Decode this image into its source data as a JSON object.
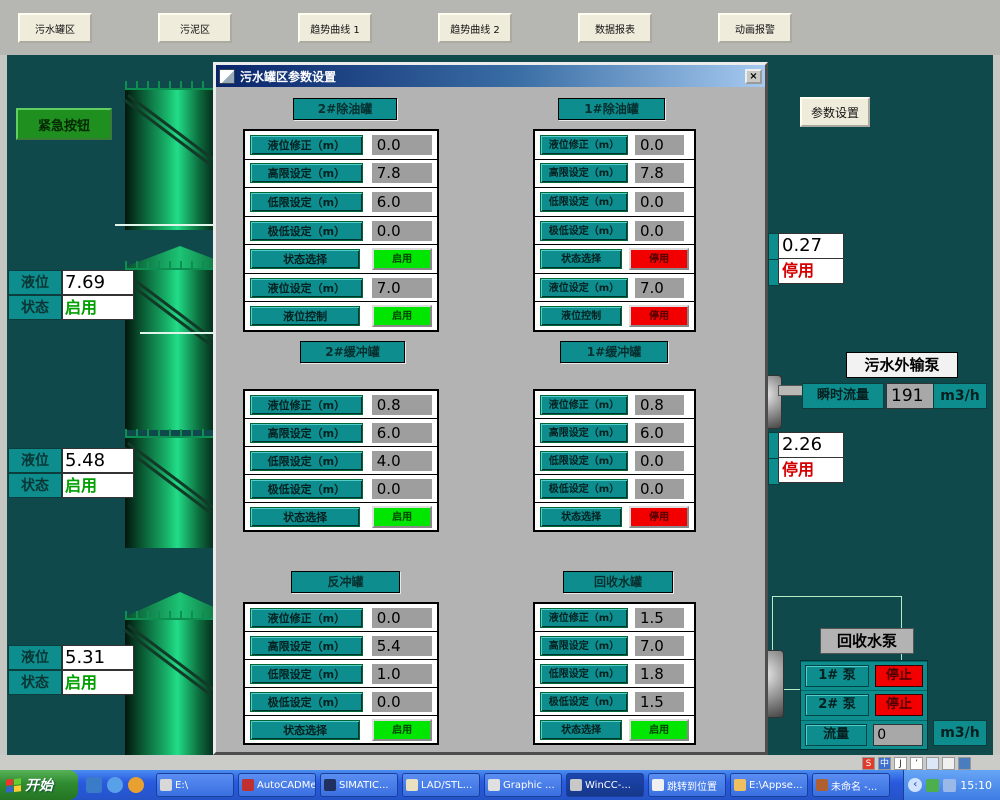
{
  "top_nav": {
    "buttons": [
      {
        "label": "污水罐区"
      },
      {
        "label": "污泥区"
      },
      {
        "label": "趋势曲线 1"
      },
      {
        "label": "趋势曲线 2"
      },
      {
        "label": "数据报表"
      },
      {
        "label": "动画报警"
      }
    ]
  },
  "left_panel": {
    "emergency_button": "紧急按钮",
    "tanks": [
      {
        "level_label": "液位",
        "level_value": "7.69",
        "status_label": "状态",
        "status_value": "启用"
      },
      {
        "level_label": "液位",
        "level_value": "5.48",
        "status_label": "状态",
        "status_value": "启用"
      },
      {
        "level_label": "液位",
        "level_value": "5.31",
        "status_label": "状态",
        "status_value": "启用"
      }
    ]
  },
  "dialog": {
    "title": "污水罐区参数设置",
    "close_label": "×",
    "panels": [
      {
        "header": "2#除油罐",
        "rows": [
          {
            "label": "液位修正（m）",
            "value": "0.0",
            "type": "v"
          },
          {
            "label": "高限设定（m）",
            "value": "7.8",
            "type": "v"
          },
          {
            "label": "低限设定（m）",
            "value": "6.0",
            "type": "v"
          },
          {
            "label": "极低设定（m）",
            "value": "0.0",
            "type": "v"
          },
          {
            "label": "状态选择",
            "value": "启用",
            "type": "g"
          },
          {
            "label": "液位设定（m）",
            "value": "7.0",
            "type": "v"
          },
          {
            "label": "液位控制",
            "value": "启用",
            "type": "g"
          }
        ]
      },
      {
        "header": "1#除油罐",
        "rows": [
          {
            "label": "液位修正（m）",
            "value": "0.0",
            "type": "v"
          },
          {
            "label": "高限设定（m）",
            "value": "7.8",
            "type": "v"
          },
          {
            "label": "低限设定（m）",
            "value": "0.0",
            "type": "v"
          },
          {
            "label": "极低设定（m）",
            "value": "0.0",
            "type": "v"
          },
          {
            "label": "状态选择",
            "value": "停用",
            "type": "r"
          },
          {
            "label": "液位设定（m）",
            "value": "7.0",
            "type": "v"
          },
          {
            "label": "液位控制",
            "value": "停用",
            "type": "r"
          }
        ]
      },
      {
        "header": "2#缓冲罐",
        "rows": [
          {
            "label": "液位修正（m）",
            "value": "0.8",
            "type": "v"
          },
          {
            "label": "高限设定（m）",
            "value": "6.0",
            "type": "v"
          },
          {
            "label": "低限设定（m）",
            "value": "4.0",
            "type": "v"
          },
          {
            "label": "极低设定（m）",
            "value": "0.0",
            "type": "v"
          },
          {
            "label": "状态选择",
            "value": "启用",
            "type": "g"
          }
        ]
      },
      {
        "header": "1#缓冲罐",
        "rows": [
          {
            "label": "液位修正（m）",
            "value": "0.8",
            "type": "v"
          },
          {
            "label": "高限设定（m）",
            "value": "6.0",
            "type": "v"
          },
          {
            "label": "低限设定（m）",
            "value": "0.0",
            "type": "v"
          },
          {
            "label": "极低设定（m）",
            "value": "0.0",
            "type": "v"
          },
          {
            "label": "状态选择",
            "value": "停用",
            "type": "r"
          }
        ]
      },
      {
        "header": "反冲罐",
        "rows": [
          {
            "label": "液位修正（m）",
            "value": "0.0",
            "type": "v"
          },
          {
            "label": "高限设定（m）",
            "value": "5.4",
            "type": "v"
          },
          {
            "label": "低限设定（m）",
            "value": "1.0",
            "type": "v"
          },
          {
            "label": "极低设定（m）",
            "value": "0.0",
            "type": "v"
          },
          {
            "label": "状态选择",
            "value": "启用",
            "type": "g"
          }
        ]
      },
      {
        "header": "回收水罐",
        "rows": [
          {
            "label": "液位修正（m）",
            "value": "1.5",
            "type": "v"
          },
          {
            "label": "高限设定（m）",
            "value": "7.0",
            "type": "v"
          },
          {
            "label": "低限设定（m）",
            "value": "1.8",
            "type": "v"
          },
          {
            "label": "极低设定（m）",
            "value": "1.5",
            "type": "v"
          },
          {
            "label": "状态选择",
            "value": "启用",
            "type": "g"
          }
        ]
      }
    ]
  },
  "right_panel": {
    "params_button": "参数设置",
    "meter_top": {
      "value": "0.27",
      "status": "停用"
    },
    "export_pump": {
      "title": "污水外输泵",
      "flow_label": "瞬时流量",
      "flow_value": "191",
      "flow_unit": "m3/h"
    },
    "meter_mid": {
      "value": "2.26",
      "status": "停用"
    },
    "recycle_pump": {
      "title": "回收水泵",
      "rows": [
        {
          "label": "1# 泵",
          "status": "停止"
        },
        {
          "label": "2# 泵",
          "status": "停止"
        },
        {
          "label": "流量",
          "value": "0"
        }
      ],
      "unit": "m3/h"
    }
  },
  "taskbar": {
    "start_label": "开始",
    "buttons": [
      {
        "label": "E:\\",
        "icon_color": "#d8d8d8"
      },
      {
        "label": "AutoCADMe...",
        "icon_color": "#c03030"
      },
      {
        "label": "SIMATIC...",
        "icon_color": "#203060"
      },
      {
        "label": "LAD/STL...",
        "icon_color": "#e8e0c0"
      },
      {
        "label": "Graphic ...",
        "icon_color": "#e0e0e0"
      },
      {
        "label": "WinCC-...",
        "icon_color": "#c8c8c8",
        "active": true
      },
      {
        "label": "跳转到位置",
        "icon_color": "#f0f0f0"
      },
      {
        "label": "E:\\Appse...",
        "icon_color": "#f0c060"
      },
      {
        "label": "未命名 -...",
        "icon_color": "#b06030"
      }
    ],
    "langbar_icons": [
      {
        "glyph": "S",
        "bg": "#e23a2a"
      },
      {
        "glyph": "中",
        "bg": "#3a6fd0"
      },
      {
        "glyph": "J",
        "bg": "#ffffff",
        "fg": "#333"
      },
      {
        "glyph": "’",
        "bg": "#ffffff",
        "fg": "#333"
      },
      {
        "glyph": "",
        "bg": "#dce8f8"
      },
      {
        "glyph": "",
        "bg": "#f0f0f0"
      },
      {
        "glyph": "",
        "bg": "#4a7cc0"
      }
    ],
    "clock": "15:10"
  },
  "colors": {
    "background": "#10494c",
    "teal_label": "#0d8d8d",
    "status_on": "#00e600",
    "status_off": "#f20000",
    "dialog_gray": "#b3b3b3"
  }
}
